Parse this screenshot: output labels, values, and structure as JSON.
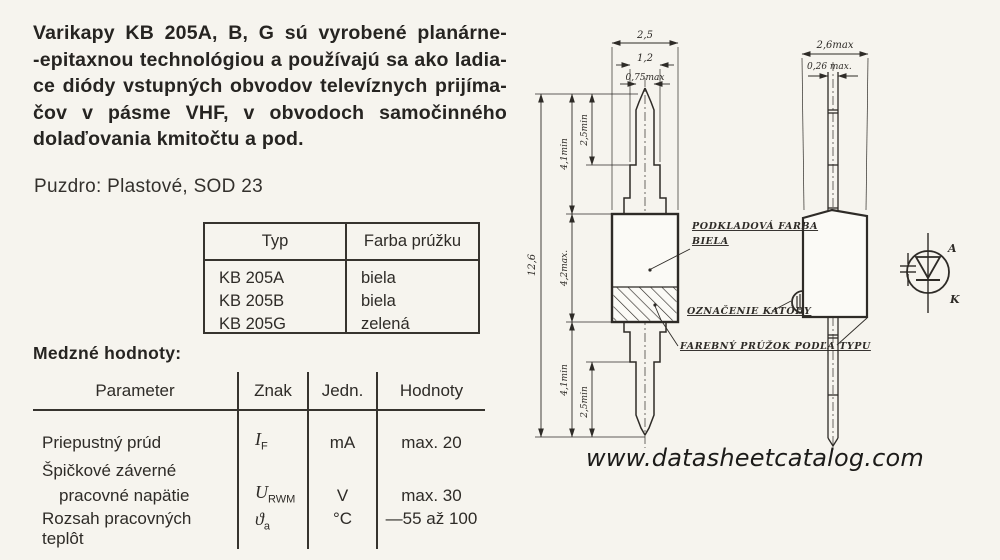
{
  "intro": {
    "lines": [
      "Varikapy KB 205A, B, G sú vyrobené planárne-",
      "-epitaxnou technológiou a používajú sa ako ladia-",
      "ce diódy vstupných obvodov televíznych prijíma-",
      "čov v pásme VHF, v obvodoch samočinného",
      "dolaďovania kmitočtu a pod."
    ]
  },
  "package_line": "Puzdro: Plastové, SOD 23",
  "type_table": {
    "headers": [
      "Typ",
      "Farba prúžku"
    ],
    "rows": [
      [
        "KB 205A",
        "biela"
      ],
      [
        "KB 205B",
        "biela"
      ],
      [
        "KB 205G",
        "zelená"
      ]
    ]
  },
  "limits": {
    "heading": "Medzné hodnoty:",
    "headers": [
      "Parameter",
      "Znak",
      "Jedn.",
      "Hodnoty"
    ],
    "rows": [
      {
        "param": "Priepustný prúd",
        "sym": "I",
        "sub": "F",
        "unit": "mA",
        "value": "max. 20"
      },
      {
        "param1": "Špičkové záverné",
        "param2": "pracovné napätie",
        "sym": "U",
        "sub": "RWM",
        "unit": "V",
        "value": "max. 30"
      },
      {
        "param": "Rozsah pracovných teplôt",
        "sym": "ϑ",
        "sub": "a",
        "unit": "°C",
        "value": "—55 až 100"
      }
    ]
  },
  "drawing": {
    "front_view": {
      "width_body": "2,5",
      "width_lead": "1,2",
      "width_tip": "0,75max",
      "height_total": "12,6",
      "lead_top": "4,1min",
      "tip_top": "2,5min",
      "body_height": "4,2max.",
      "lead_bottom": "4,1min",
      "tip_bottom": "2,5min"
    },
    "side_view": {
      "width_body": "2,6max",
      "lead_thickness": "0,26 max."
    },
    "callouts": {
      "base_color_line1": "PODKLADOVÁ FARBA",
      "base_color_line2": "BIELA",
      "cathode_mark": "OZNAČENIE KATÓDY",
      "color_stripe": "FAREBNÝ PRÚŽOK PODĽA TYPU"
    },
    "symbol": {
      "anode": "A",
      "cathode": "K"
    }
  },
  "watermark": "www.datasheetcatalog.com"
}
